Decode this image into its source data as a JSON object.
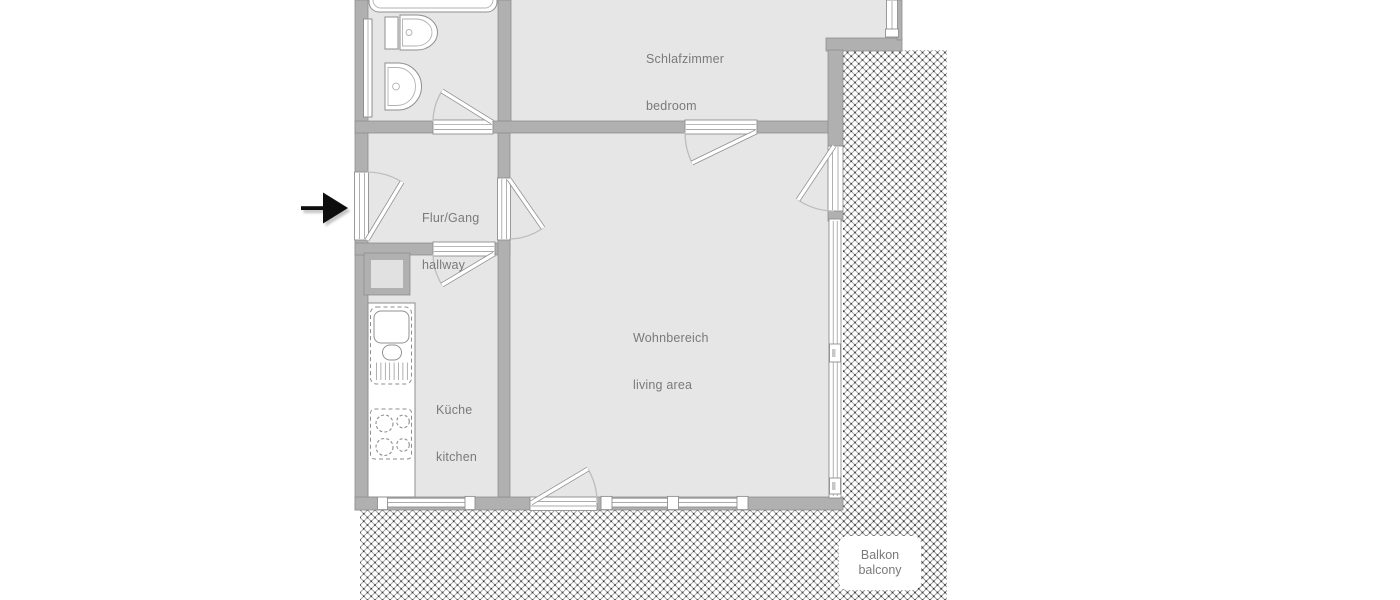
{
  "rooms": {
    "bedroom": {
      "de": "Schlafzimmer",
      "en": "bedroom"
    },
    "hallway": {
      "de": "Flur/Gang",
      "en": "hallway"
    },
    "living_area": {
      "de": "Wohnbereich",
      "en": "living area"
    },
    "kitchen": {
      "de": "Küche",
      "en": "kitchen"
    },
    "balcony": {
      "de": "Balkon",
      "en": "balcony"
    }
  },
  "icons": {
    "entrance_arrow": "➜",
    "fixtures": [
      "bathtub",
      "toilet",
      "washbasin",
      "kitchen-counter",
      "kitchen-sink",
      "stove",
      "shaft"
    ]
  },
  "colors": {
    "background": "#ffffff",
    "wall": "#b0b0b0",
    "wall_edge": "#8f8f8f",
    "floor": "#e6e6e6",
    "floor_dark": "#e1e1e1",
    "fixture_stroke": "#8f8f8f",
    "hatch_line": "#9c9c9c",
    "hatch_dot": "#3c3c3c",
    "label_text": "#7a7a7a",
    "arrow": "#0d0d0d"
  }
}
